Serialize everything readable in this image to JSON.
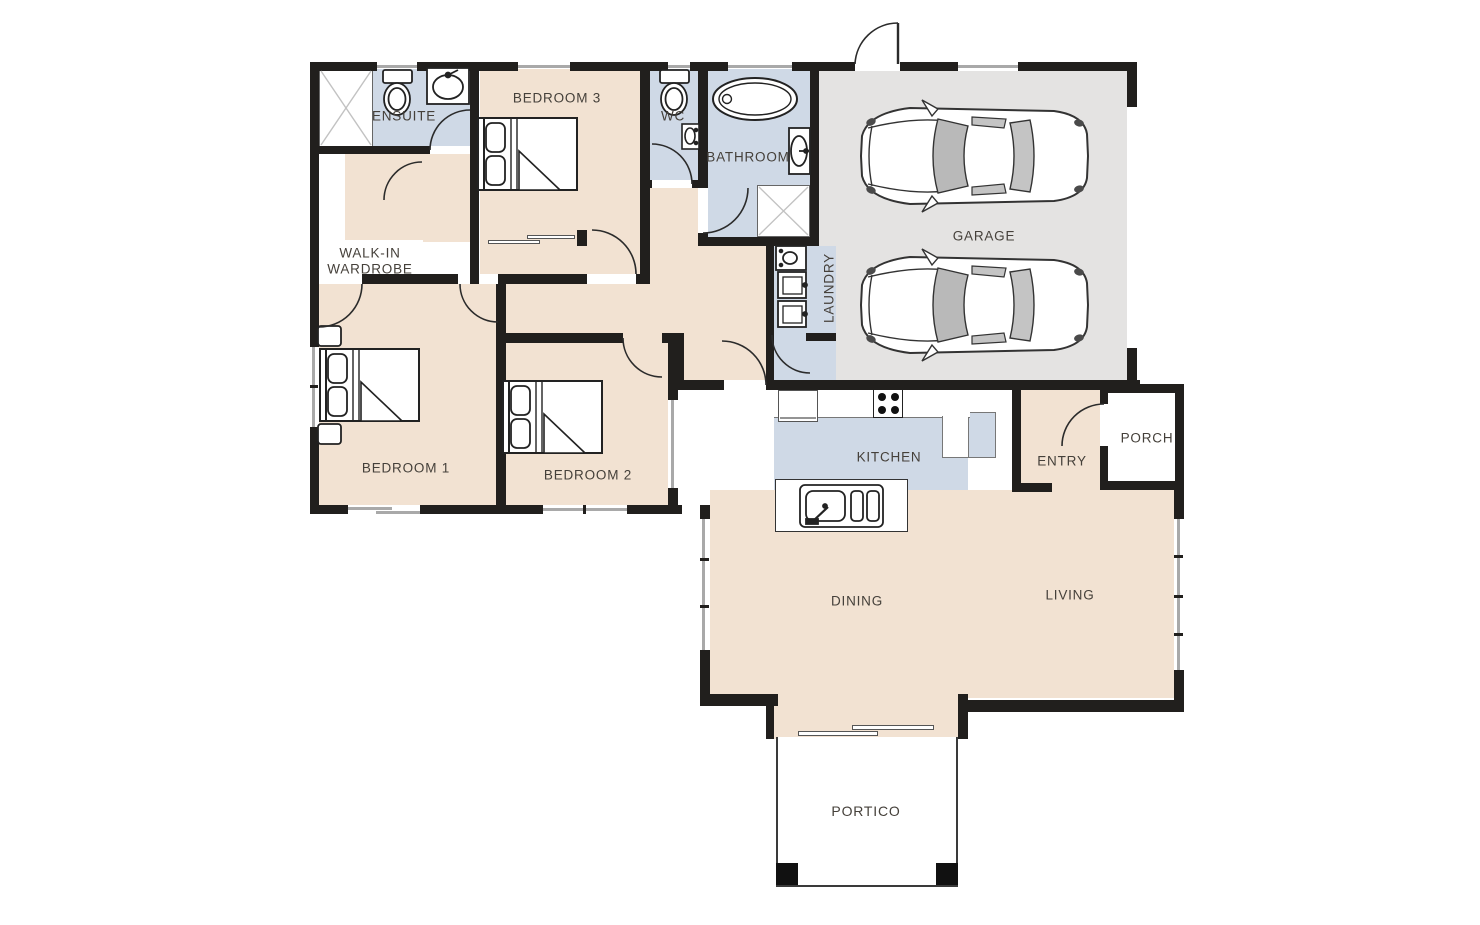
{
  "title": "Residential floor plan",
  "colors": {
    "floor_rooms": "#f2e2d2",
    "floor_wet_areas": "#cfd9e6",
    "floor_garage": "#e4e3e2",
    "walls": "#211f1d",
    "label_text": "#45403a",
    "background": "#ffffff"
  },
  "rooms": {
    "ensuite": {
      "label": "ENSUITE"
    },
    "wiw": {
      "label": "WALK-IN WARDROBE"
    },
    "bedroom3": {
      "label": "BEDROOM 3"
    },
    "wc": {
      "label": "WC"
    },
    "bathroom": {
      "label": "BATHROOM"
    },
    "garage": {
      "label": "GARAGE"
    },
    "laundry": {
      "label": "LAUNDRY"
    },
    "bedroom1": {
      "label": "BEDROOM 1"
    },
    "bedroom2": {
      "label": "BEDROOM 2"
    },
    "kitchen": {
      "label": "KITCHEN"
    },
    "entry": {
      "label": "ENTRY"
    },
    "porch": {
      "label": "PORCH"
    },
    "dining": {
      "label": "DINING"
    },
    "living": {
      "label": "LIVING"
    },
    "portico": {
      "label": "PORTICO"
    }
  },
  "fixtures": [
    "shower-ensuite",
    "toilet-ensuite",
    "basin-ensuite",
    "robe-sliding-doors",
    "toilet-wc",
    "basin-wc",
    "bathtub",
    "basin-bathroom",
    "shower-bathroom",
    "laundry-trough",
    "washing-machine",
    "dryer",
    "fridge",
    "cooktop",
    "pantry",
    "island-bench",
    "kitchen-sink",
    "bed-queen-bedroom1",
    "bed-queen-bedroom2",
    "bed-queen-bedroom3",
    "nightstands-bedroom1",
    "car-1",
    "car-2",
    "portico-posts"
  ]
}
